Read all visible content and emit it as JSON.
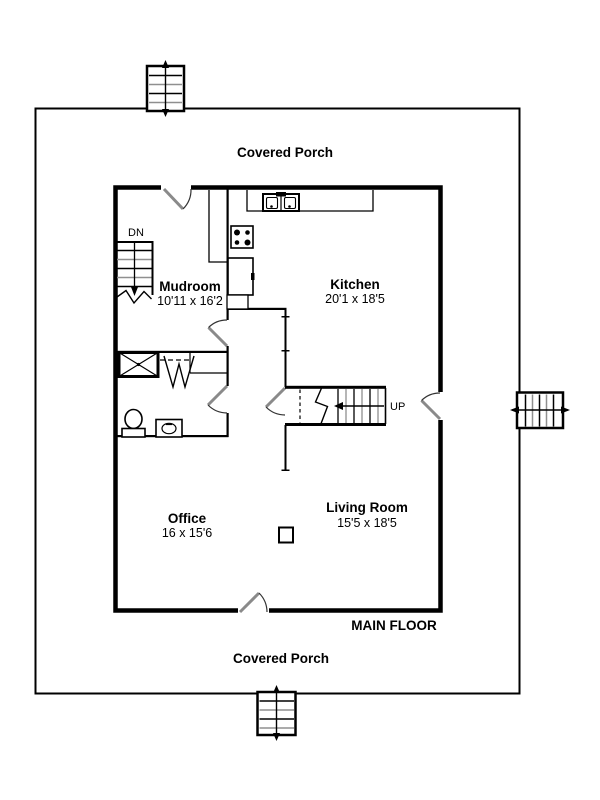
{
  "plan": {
    "floor_label": "MAIN FLOOR",
    "porch_label_top": "Covered Porch",
    "porch_label_bottom": "Covered Porch",
    "stair_down_label": "DN",
    "stair_up_label": "UP",
    "rooms": {
      "mudroom": {
        "name": "Mudroom",
        "dims": "10'11 x 16'2"
      },
      "kitchen": {
        "name": "Kitchen",
        "dims": "20'1 x 18'5"
      },
      "office": {
        "name": "Office",
        "dims": "16 x 15'6"
      },
      "living_room": {
        "name": "Living Room",
        "dims": "15'5 x 18'5"
      }
    },
    "colors": {
      "wall": "#000000",
      "door_leaf": "#8a8a8a",
      "tread_alt": "#8f8f8f",
      "background": "#ffffff"
    }
  }
}
